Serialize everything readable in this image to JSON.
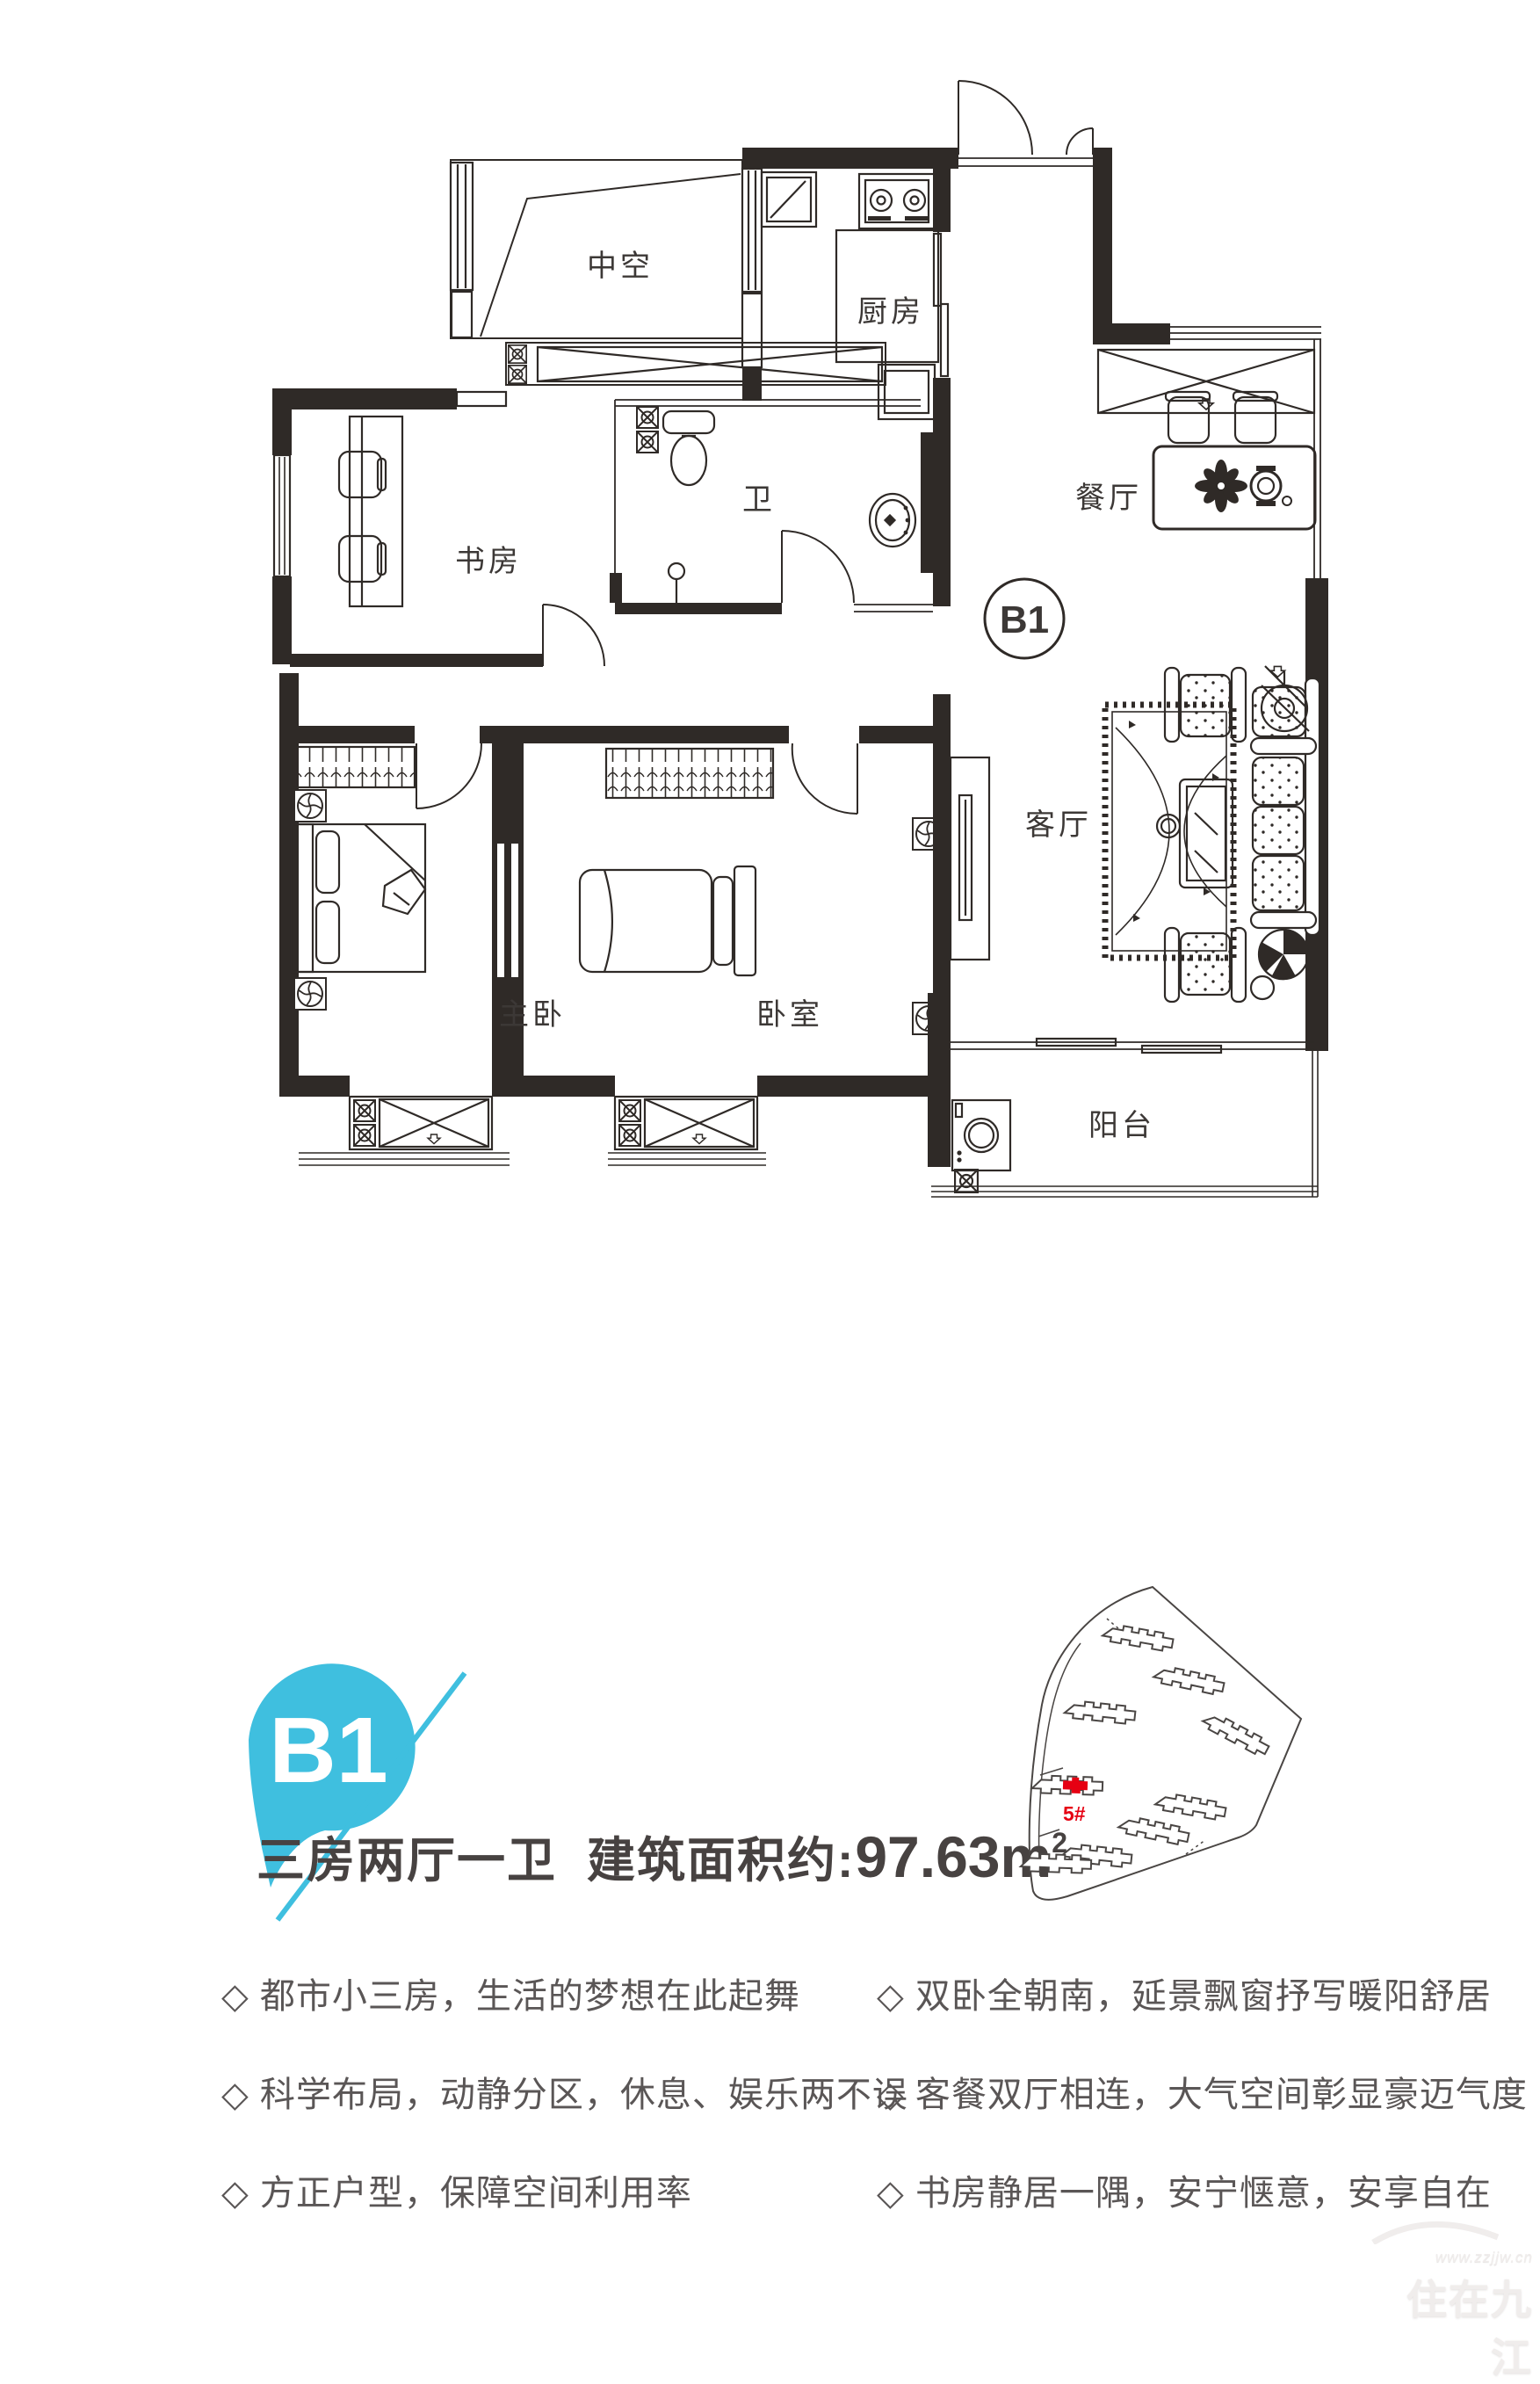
{
  "floor_plan": {
    "unit_circle_label": "B1",
    "rooms": {
      "void": "中空",
      "kitchen": "厨房",
      "bath": "卫",
      "study": "书房",
      "dining": "餐厅",
      "living": "客厅",
      "master": "主卧",
      "bedroom": "卧室",
      "balcony": "阳台"
    }
  },
  "badge": {
    "label": "B1",
    "color": "#3fbfdf"
  },
  "summary": {
    "layout": "三房两厅一卫",
    "area_prefix": "建筑面积约:",
    "area_value": "97.63",
    "area_unit": "m",
    "area_exponent": "2"
  },
  "site_plan": {
    "highlighted_building": "5#",
    "highlight_color": "#e60012"
  },
  "features": {
    "left": [
      "◇ 都市小三房，生活的梦想在此起舞",
      "◇ 科学布局，动静分区，休息、娱乐两不误",
      "◇ 方正户型，保障空间利用率"
    ],
    "right": [
      "◇ 双卧全朝南，延景飘窗抒写暖阳舒居",
      "◇ 客餐双厅相连，大气空间彰显豪迈气度",
      "◇ 书房静居一隅，安宁惬意，安享自在"
    ]
  },
  "watermark": {
    "site_text": "www.zzjjw.cn",
    "name": "住在九江"
  }
}
